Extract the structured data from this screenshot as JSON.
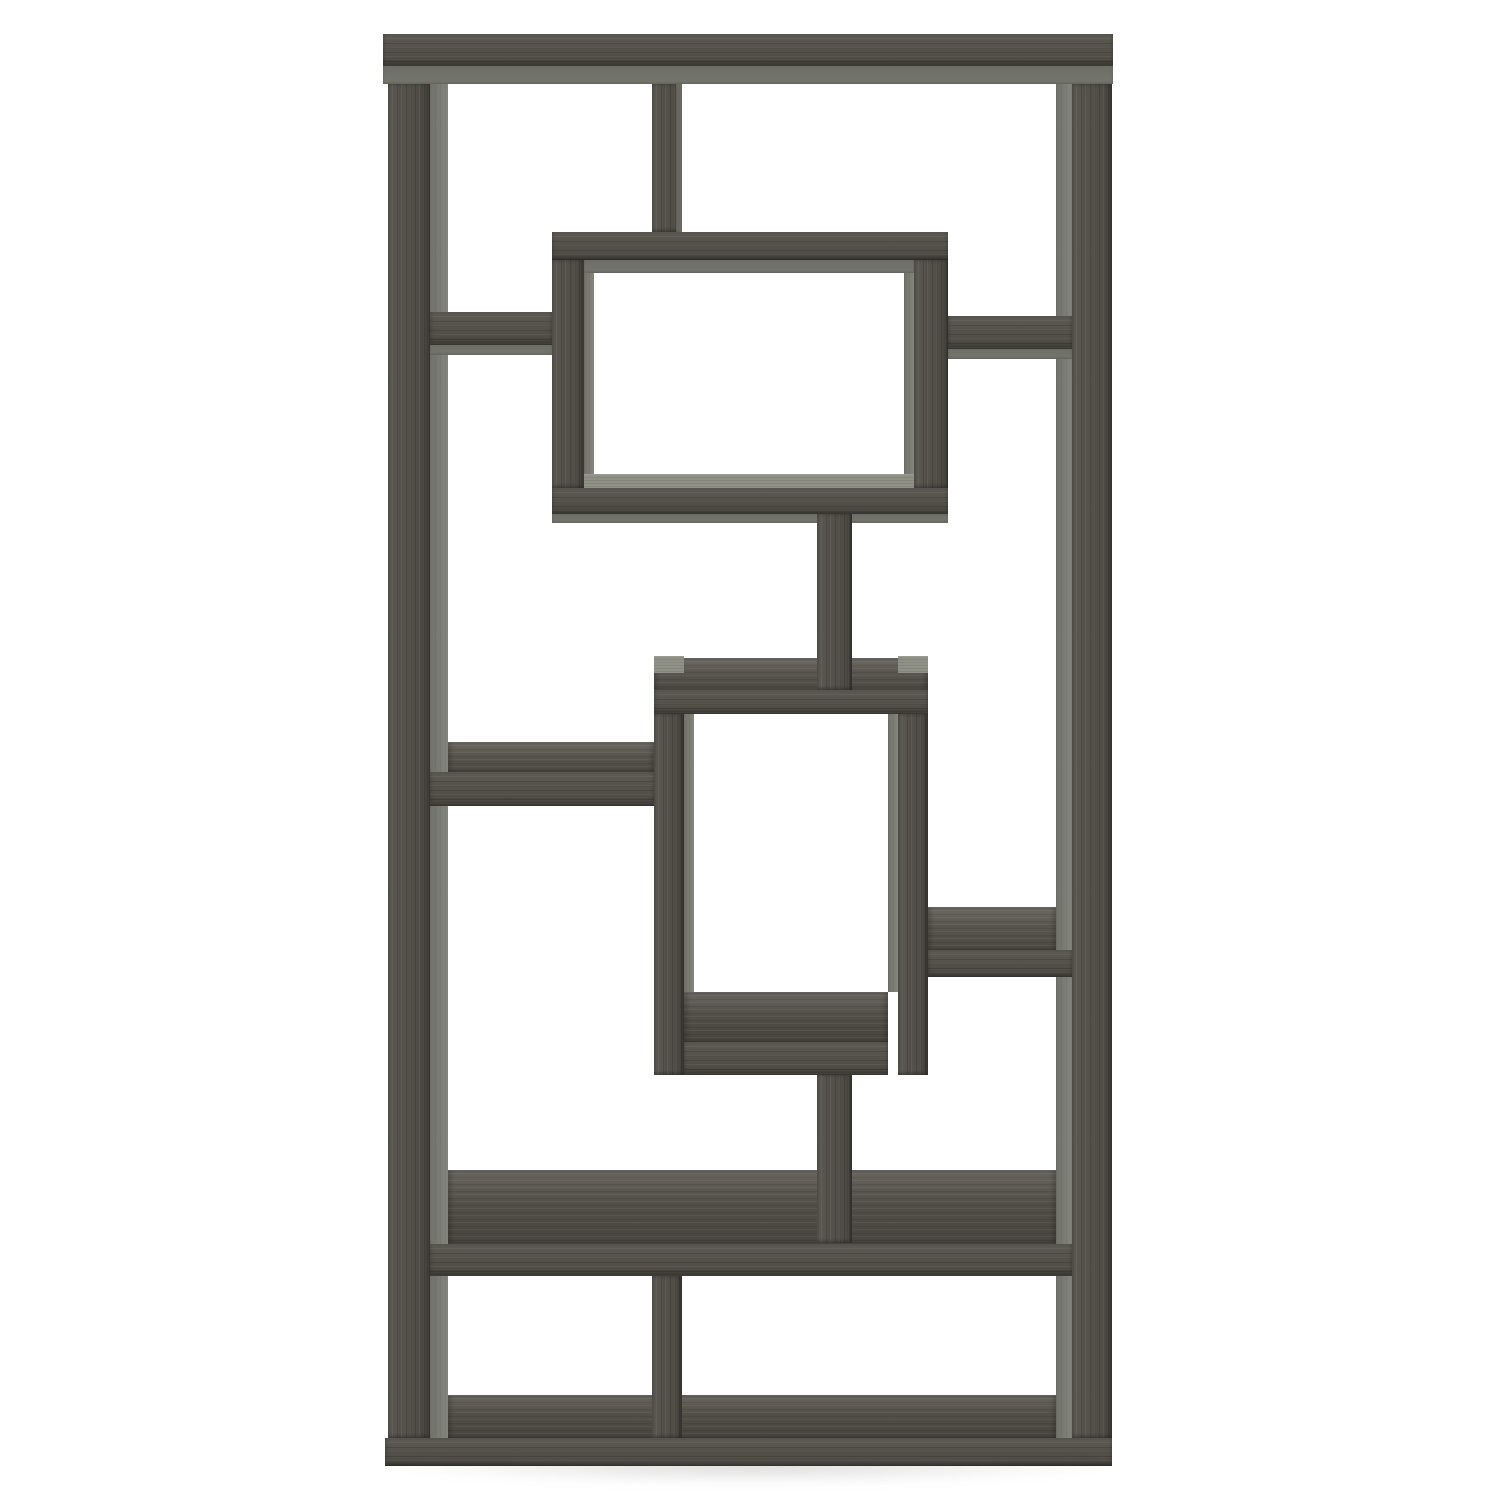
{
  "meta": {
    "description": "Product photograph of a tall rectangular geometric bookcase with ten asymmetric open compartments formed by interlocking shelves, finished in weathered grey oak-grain wood, shown straight-on against a plain white background."
  },
  "colors": {
    "background": "#ffffff",
    "wood-face": "#54514a",
    "wood-face-dark": "#48453f",
    "wood-top-light": "#6b6860",
    "wood-underside": "#74766e",
    "wood-inner-side": "#7d7f75",
    "wood-end-cap": "#8f9186",
    "edge-shadow": "#3b3933",
    "floor-shadow": "#b8b8b3"
  }
}
